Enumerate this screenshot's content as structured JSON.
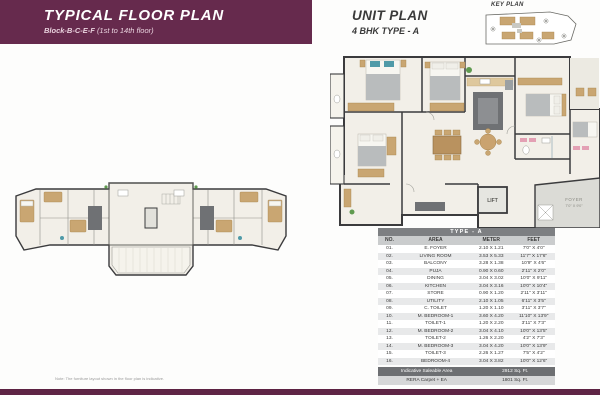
{
  "header": {
    "title": "TYPICAL FLOOR PLAN",
    "subtitle_block": "Block-B-C-E-F",
    "subtitle_floors": "(1st to 14th floor)"
  },
  "unit_header": {
    "title": "UNIT PLAN",
    "subtitle": "4 BHK TYPE - A"
  },
  "key_plan": {
    "label": "KEY PLAN"
  },
  "unit_plan_labels": {
    "lift": "LIFT",
    "foyer": "FOYER",
    "foyer_dim": "7'0\" X 9'0\""
  },
  "area_table": {
    "title": "TYPE - A",
    "columns": [
      "NO.",
      "AREA",
      "METER",
      "FEET"
    ],
    "rows": [
      {
        "no": "01.",
        "area": "E. FOYER",
        "meter": "2.10 X 1.21",
        "feet": "7'0\" X 4'0\""
      },
      {
        "no": "02.",
        "area": "LIVING ROOM",
        "meter": "3.53 X 5.33",
        "feet": "11'7\" X 17'6\""
      },
      {
        "no": "03.",
        "area": "BALCONY",
        "meter": "3.28 X 1.38",
        "feet": "10'9\" X 4'6\""
      },
      {
        "no": "04.",
        "area": "PUJA",
        "meter": "0.90 X 0.60",
        "feet": "2'11\" X 2'0\""
      },
      {
        "no": "05.",
        "area": "DINING",
        "meter": "3.04 X 3.02",
        "feet": "10'0\" X 9'11\""
      },
      {
        "no": "06.",
        "area": "KITCHEN",
        "meter": "3.04 X 3.16",
        "feet": "10'0\" X 10'4\""
      },
      {
        "no": "07.",
        "area": "STORE",
        "meter": "0.90 X 1.20",
        "feet": "2'11\" X 3'11\""
      },
      {
        "no": "08.",
        "area": "UTILITY",
        "meter": "2.10 X 1.05",
        "feet": "6'11\" X 3'5\""
      },
      {
        "no": "09.",
        "area": "C. TOILET",
        "meter": "1.20 X 1.10",
        "feet": "3'11\" X 3'7\""
      },
      {
        "no": "10.",
        "area": "M. BEDROOM-1",
        "meter": "3.60 X 4.20",
        "feet": "11'10\" X 13'9\""
      },
      {
        "no": "11.",
        "area": "TOILET-1",
        "meter": "1.20 X 2.20",
        "feet": "3'11\" X 7'3\""
      },
      {
        "no": "12.",
        "area": "M. BEDROOM-2",
        "meter": "3.04 X 4.10",
        "feet": "10'0\" X 13'5\""
      },
      {
        "no": "13.",
        "area": "TOILET-2",
        "meter": "1.26 X 2.20",
        "feet": "4'2\" X 7'3\""
      },
      {
        "no": "14.",
        "area": "M. BEDROOM-3",
        "meter": "3.04 X 4.20",
        "feet": "10'0\" X 13'9\""
      },
      {
        "no": "15.",
        "area": "TOILET-3",
        "meter": "2.26 X 1.27",
        "feet": "7'5\" X 4'2\""
      },
      {
        "no": "16.",
        "area": "BEDROOM-4",
        "meter": "3.04 X 3.82",
        "feet": "10'0\" X 12'6\""
      }
    ],
    "footer": [
      {
        "label": "Indicative Saleable Area",
        "value": "2912 Sq. Ft."
      },
      {
        "label": "RERA Carpet + EA",
        "value": "1801 Sq. Ft."
      }
    ]
  },
  "footer_note": {
    "disclaimer": "Note: The furniture layout shown in the floor plan is indicative."
  },
  "colors": {
    "brand_purple": "#662a4d",
    "strip_purple": "#5d2343",
    "table_header_gray": "#7d7f82",
    "accent_teal": "#4f9aa8",
    "floor_cream": "#f2efe8",
    "wall_dark": "#3b3b3d",
    "furniture_tan": "#c9a672"
  }
}
